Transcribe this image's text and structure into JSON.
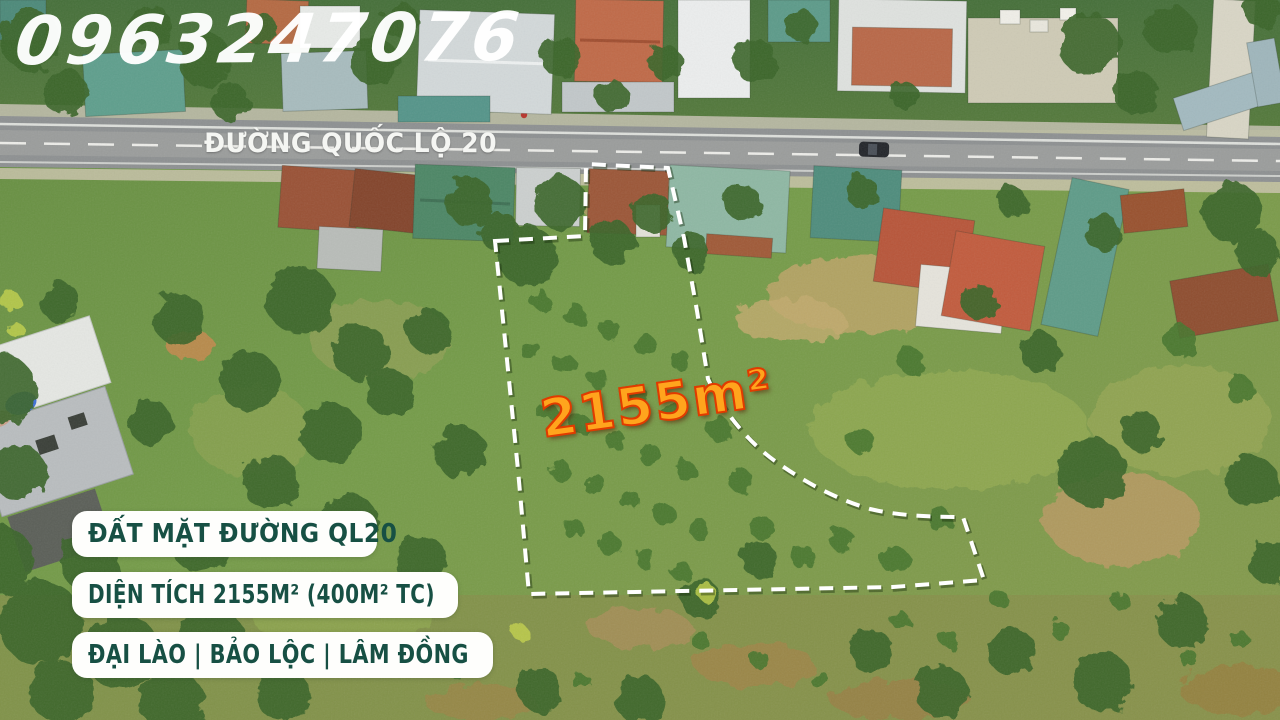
{
  "overlay": {
    "phone": "0963247076",
    "road_name": "ĐƯỜNG QUỐC LỘ 20",
    "area_badge": "2155m²",
    "info_cards": [
      {
        "text": "ĐẤT MẶT ĐƯỜNG QL20"
      },
      {
        "text": "DIỆN TÍCH 2155M² (400M² TC)"
      },
      {
        "text": "ĐẠI LÀO | BẢO LỘC | LÂM ĐỒNG"
      }
    ]
  },
  "colors": {
    "watermark_color": "#ffffff",
    "road_text": "#f5f6f3",
    "area_fill": "#ffa41d",
    "area_stroke": "#e13b00",
    "card_bg": "#fefefc",
    "card_text": "#175044",
    "outline_color": "#ffffff"
  }
}
